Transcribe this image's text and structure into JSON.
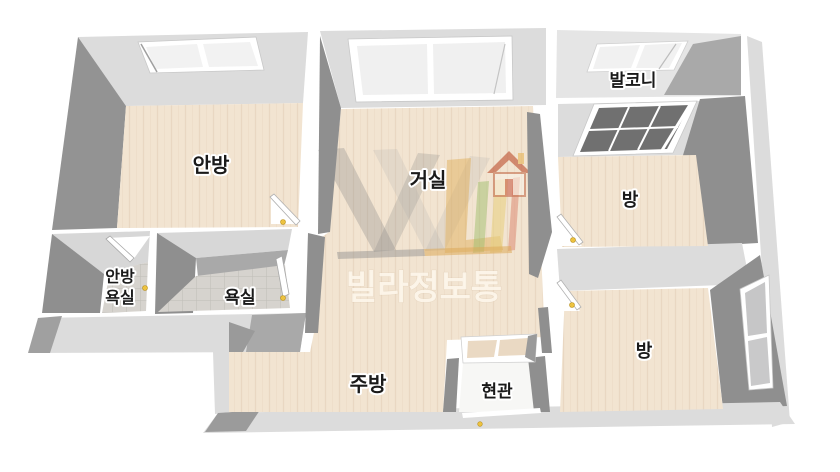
{
  "plan": {
    "rooms": {
      "master_bedroom": "안방",
      "living_room": "거실",
      "balcony": "발코니",
      "room_top_right": "방",
      "room_bottom_right": "방",
      "master_bath_line1": "안방",
      "master_bath_line2": "욕실",
      "bathroom": "욕실",
      "kitchen": "주방",
      "entrance": "현관"
    },
    "watermark": {
      "text": "빌라정보통"
    },
    "colors": {
      "wall_top": "#dcdcdc",
      "wall_shadow": "#8f8f8f",
      "wall_medium": "#a9a9a9",
      "floor_wood": "#f2e4d1",
      "floor_tile": "#d6d3ce",
      "entrance_floor": "#f7f7f5",
      "balcony_floor": "#e5e5e5",
      "window_pane": "#f2f2f2",
      "grid_window_pane": "#707070",
      "door_handle": "#edc23f",
      "watermark_orange": "#d69e40",
      "watermark_red": "#d84b30",
      "watermark_green": "#9cb868"
    }
  }
}
